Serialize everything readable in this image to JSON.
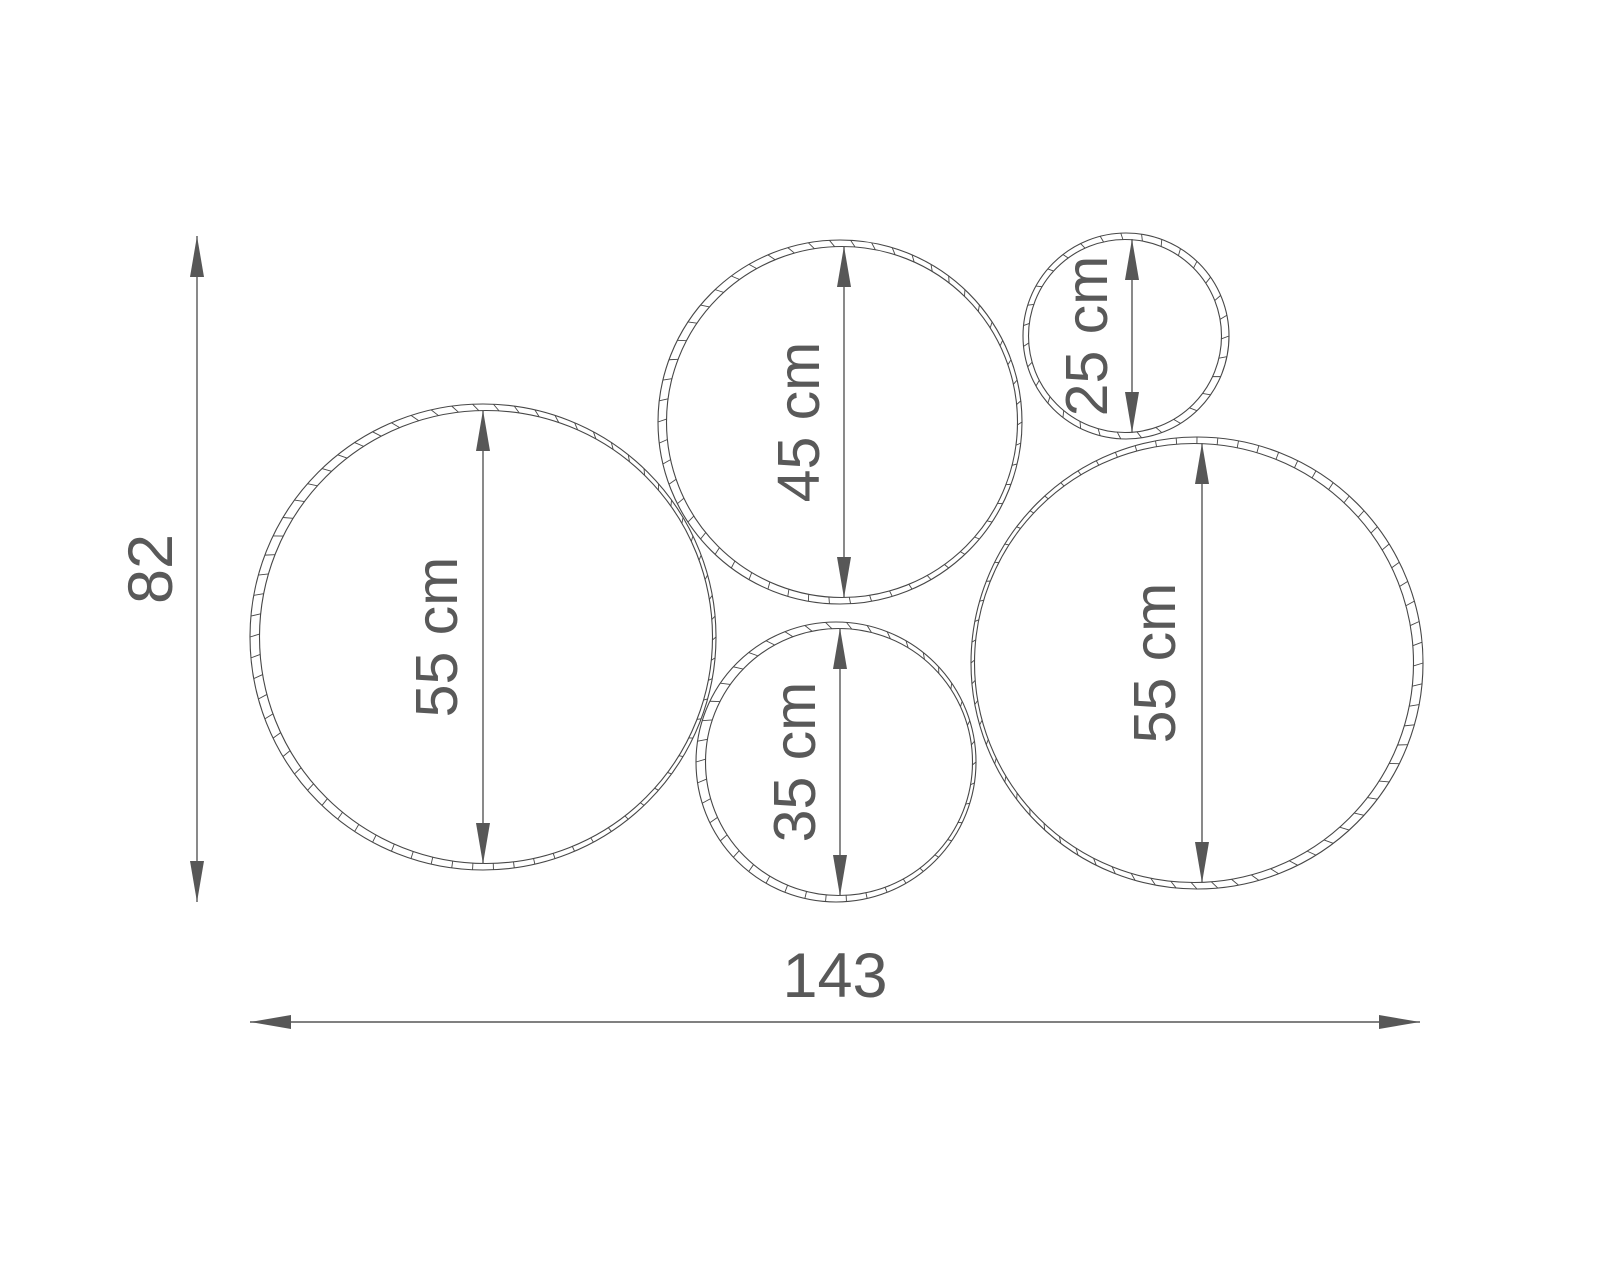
{
  "diagram": {
    "type": "technical-dimension-drawing",
    "units": "cm",
    "description": "Five overlapping decorative rings shown front-on, each with a vertical diameter dimension, plus overall width and height dimensions",
    "colors": {
      "background": "#ffffff",
      "outline": "#474747",
      "dimension": "#575757",
      "label": "#595959"
    },
    "circles": [
      {
        "id": "left-large",
        "label": "55 cm",
        "diameter_cm": 55,
        "cx": 483,
        "cy": 637,
        "r": 233,
        "arrow_x": 483,
        "inner_dx": 3,
        "label_dx": -46
      },
      {
        "id": "top-middle",
        "label": "45 cm",
        "diameter_cm": 45,
        "cx": 840,
        "cy": 422,
        "r": 182,
        "arrow_x": 844,
        "inner_dx": 2,
        "label_dx": -45
      },
      {
        "id": "top-right-small",
        "label": "25 cm",
        "diameter_cm": 25,
        "cx": 1126,
        "cy": 336,
        "r": 103,
        "arrow_x": 1132,
        "inner_dx": -1,
        "label_dx": -45
      },
      {
        "id": "bottom-middle",
        "label": "35 cm",
        "diameter_cm": 35,
        "cx": 836,
        "cy": 762,
        "r": 140,
        "arrow_x": 840,
        "inner_dx": 3,
        "label_dx": -45
      },
      {
        "id": "right-large",
        "label": "55 cm",
        "diameter_cm": 55,
        "cx": 1197,
        "cy": 663,
        "r": 226,
        "arrow_x": 1202,
        "inner_dx": -3,
        "label_dx": -47
      }
    ],
    "overall_height": {
      "label": "82",
      "value": 82,
      "line_x": 197,
      "y1": 236,
      "y2": 902,
      "text_x": 151,
      "text_y": 569
    },
    "overall_width": {
      "label": "143",
      "value": 143,
      "line_y": 1022,
      "x1": 250,
      "x2": 1420,
      "text_x": 835,
      "text_y": 976
    },
    "arrow": {
      "length": 41,
      "half_width": 7
    },
    "rim": {
      "inner_offset": 6.5,
      "tick_spacing_px": 21,
      "tick_slant_px": 3
    }
  }
}
